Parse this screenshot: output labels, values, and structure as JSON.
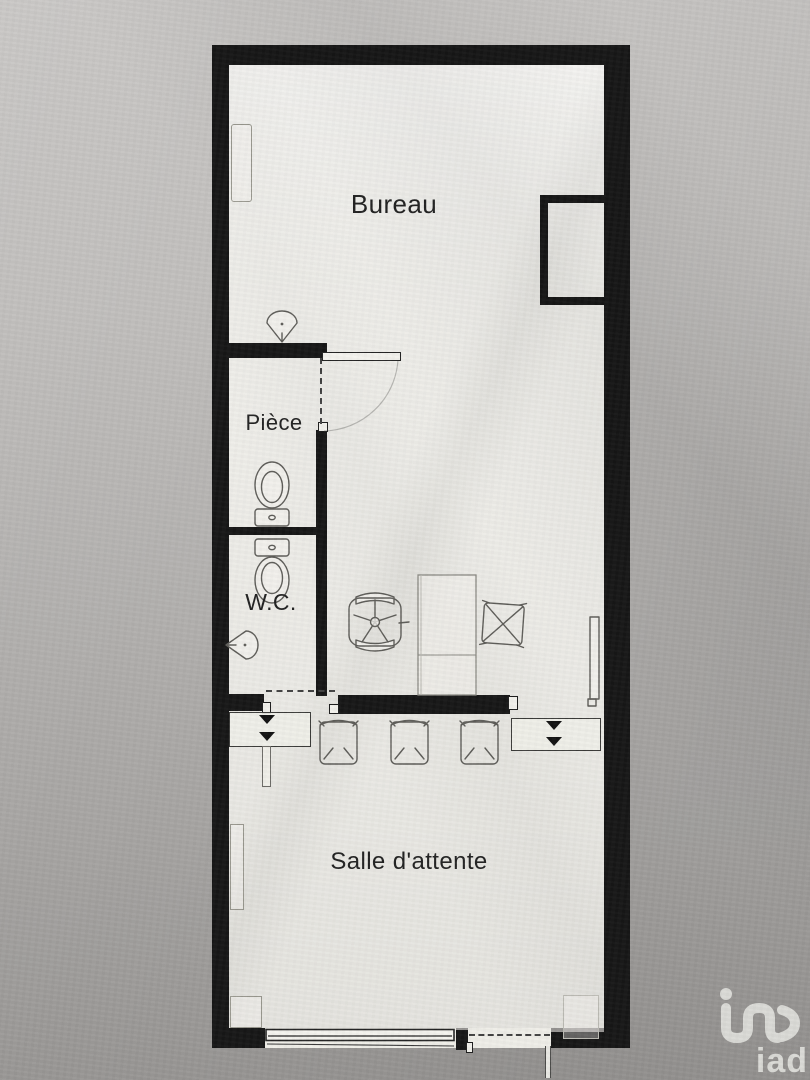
{
  "meta": {
    "document_type": "floor-plan scan",
    "orientation": "portrait"
  },
  "rooms": [
    {
      "id": "bureau",
      "label": "Bureau"
    },
    {
      "id": "piece",
      "label": "Pièce"
    },
    {
      "id": "wc",
      "label": "W.C."
    },
    {
      "id": "salle_attente",
      "label": "Salle d'attente"
    }
  ],
  "fixtures": [
    "wash-basin",
    "toilet",
    "toilet",
    "corner-sink",
    "office-chair",
    "desk",
    "visitor-chair",
    "radiator",
    "waiting-chair",
    "waiting-chair",
    "waiting-chair",
    "bench",
    "bench",
    "window",
    "entrance-door",
    "closet"
  ],
  "branding": {
    "logo_text": "iad",
    "logo_color": "#dadad6"
  },
  "colors": {
    "wall": "#161616",
    "floor": "#efeee9",
    "background_top": "#c8c6c4",
    "background_bottom": "#989694",
    "pencil": "#5e5d59"
  }
}
